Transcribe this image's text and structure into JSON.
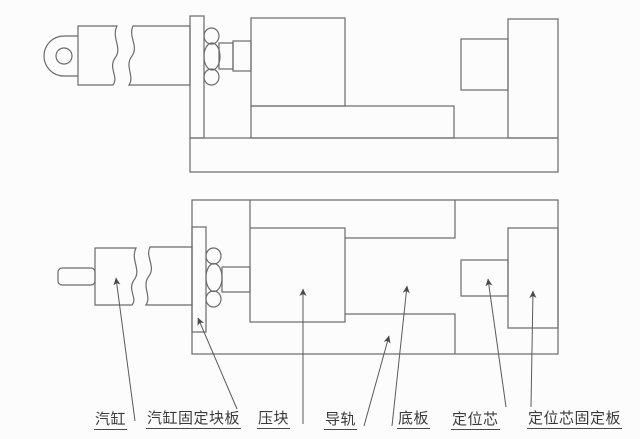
{
  "diagram": {
    "type": "engineering-assembly-drawing",
    "views": {
      "top": "side-elevation-view",
      "bottom": "plan-view"
    },
    "labels": [
      {
        "id": "cylinder",
        "text": "汽缸"
      },
      {
        "id": "cylinder-fixing-block-plate",
        "text": "汽缸固定块板"
      },
      {
        "id": "press-block",
        "text": "压块"
      },
      {
        "id": "guide-rail",
        "text": "导轨"
      },
      {
        "id": "base-plate",
        "text": "底板"
      },
      {
        "id": "locating-core",
        "text": "定位芯"
      },
      {
        "id": "locating-core-fixing-plate",
        "text": "定位芯固定板"
      }
    ],
    "colors": {
      "line": "#6b6b6b",
      "leader": "#5a5a5a",
      "label_text": "#3a3a3a",
      "background": "#fcfcfc"
    }
  }
}
